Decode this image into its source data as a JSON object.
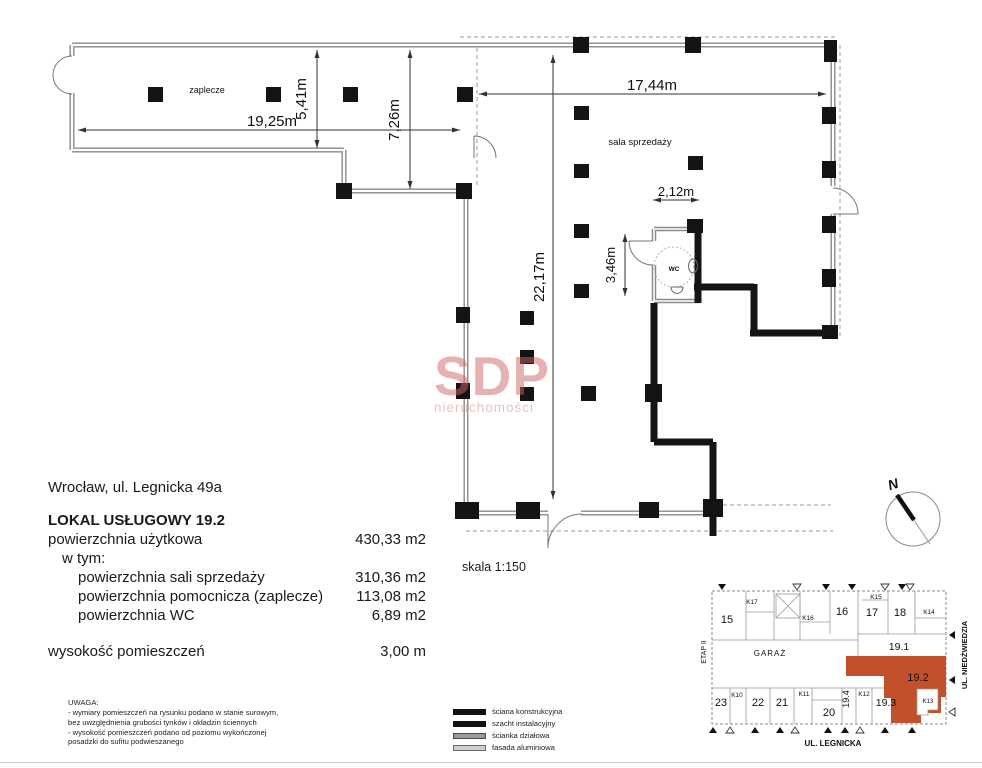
{
  "address": "Wrocław, ul. Legnicka 49a",
  "property": {
    "title": "LOKAL USŁUGOWY 19.2",
    "area_total_label": "powierzchnia użytkowa",
    "area_total_value": "430,33 m2",
    "in_that": "w tym:",
    "area_sala_label": "powierzchnia sali sprzedaży",
    "area_sala_value": "310,36 m2",
    "area_aux_label": "powierzchnia pomocnicza (zaplecze)",
    "area_aux_value": "113,08 m2",
    "area_wc_label": "powierzchnia WC",
    "area_wc_value": "6,89 m2",
    "height_label": "wysokość pomieszczeń",
    "height_value": "3,00 m"
  },
  "scale_label": "skala 1:150",
  "plan": {
    "room_zaplecze": "zaplecze",
    "room_sala": "sala sprzedaży",
    "room_wc": "WC",
    "dim_zaplecze_width": "19,25m",
    "dim_zaplecze_depth": "5,41m",
    "dim_step_depth": "7,26m",
    "dim_sala_width": "17,44m",
    "dim_sala_depth": "22,17m",
    "dim_wc_width": "2,12m",
    "dim_wc_depth": "3,46m",
    "compass_north": "N"
  },
  "notes": {
    "title": "UWAGA:",
    "line1": "- wymiary pomieszczeń na rysunku podano w stanie surowym, bez uwzględnienia grubości tynków i okładzin ściennych",
    "line2": "- wysokość pomieszczeń podano od poziomu wykończonej posadzki do sufitu podwieszanego"
  },
  "legend": {
    "item1": "ściana konstrukcyjna",
    "item2": "szacht instalacyjny",
    "item3": "ścianka działowa",
    "item4": "fasada aluminiowa"
  },
  "watermark": {
    "name": "SDP",
    "subtitle": "nieruchomości"
  },
  "sitemap": {
    "highlight_color": "#c1502b",
    "street_right": "UL. NIEDŹWIEDZIA",
    "street_bottom": "UL. LEGNICKA",
    "etap": "ETAP II",
    "garage": "GARAŻ",
    "u15": "15",
    "k17": "K17",
    "k16": "K16",
    "u16": "16",
    "u17": "17",
    "k15": "K15",
    "u18": "18",
    "k14": "K14",
    "u191": "19.1",
    "u192": "19.2",
    "u23": "23",
    "k10": "K10",
    "u22": "22",
    "u21": "21",
    "k11": "K11",
    "u20": "20",
    "u194": "19.4",
    "k12": "K12",
    "u193": "19.3",
    "k13": "K13"
  }
}
